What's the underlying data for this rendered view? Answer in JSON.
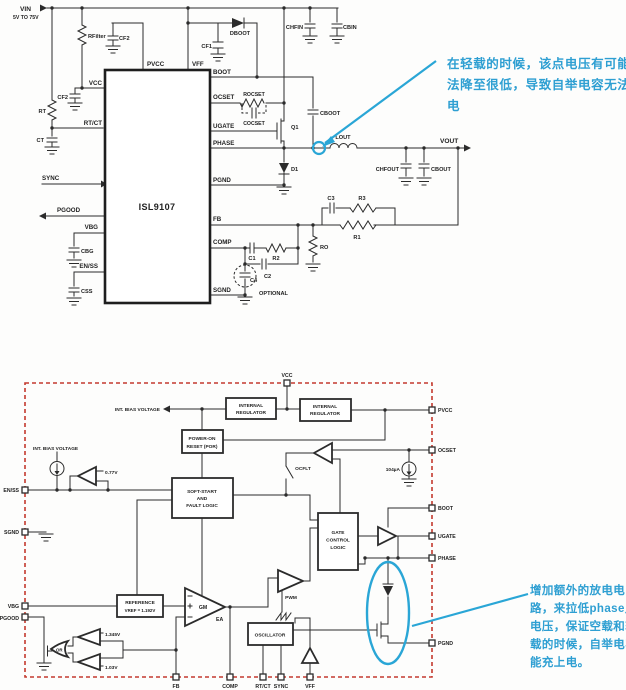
{
  "colors": {
    "accent": "#2aa6d6",
    "dashed_border": "#c43a2e",
    "ink": "#2b2b2b"
  },
  "top": {
    "ic": "ISL9107",
    "vin": "VIN",
    "vin_range": "5V TO 75V",
    "pins": {
      "vcc": "VCC",
      "rtct": "RT/CT",
      "sync": "SYNC",
      "pgood": "PGOOD",
      "vbg": "VBG",
      "enss": "EN/SS",
      "pvcc": "PVCC",
      "vff": "VFF",
      "boot": "BOOT",
      "ocset": "OCSET",
      "ugate": "UGATE",
      "phase": "PHASE",
      "pgnd": "PGND",
      "fb": "FB",
      "comp": "COMP",
      "sgnd": "SGND"
    },
    "parts": {
      "rfilter": "RFilter",
      "cf2": "CF2",
      "cf1": "CF1",
      "dboot": "DBOOT",
      "chfin": "CHFIN",
      "cbin": "CBIN",
      "rt": "RT",
      "ct": "CT",
      "cbg": "CBG",
      "css": "CSS",
      "rocset": "ROCSET",
      "cocset": "COCSET",
      "q1": "Q1",
      "cboot": "CBOOT",
      "d1": "D1",
      "lout": "LOUT",
      "vout": "VOUT",
      "chfout": "CHFOUT",
      "cbout": "CBOUT",
      "c1": "C1",
      "c2": "C2",
      "c3": "C3",
      "c4": "C4",
      "r1": "R1",
      "r2": "R2",
      "r3": "R3",
      "ro": "RO",
      "optional": "OPTIONAL"
    }
  },
  "bd": {
    "pins": {
      "vcc": "VCC",
      "pvcc": "PVCC",
      "ocset": "OCSET",
      "boot": "BOOT",
      "ugate": "UGATE",
      "phase": "PHASE",
      "pgnd": "PGND",
      "enss": "EN/SS",
      "sgnd": "SGND",
      "vbg": "VBG",
      "pgood": "PGOOD",
      "fb": "FB",
      "comp": "COMP",
      "rtct": "RT/CT",
      "sync": "SYNC",
      "vff": "VFF"
    },
    "blocks": {
      "int_reg": [
        "INTERNAL",
        "REGULATOR"
      ],
      "por": [
        "POWER-ON",
        "RESET (POR)"
      ],
      "ss": [
        "SOFT-START",
        "AND",
        "FAULT LOGIC"
      ],
      "ref": [
        "REFERENCE",
        "VREF = 1.192V"
      ],
      "osc": "OSCILLATOR",
      "gcl": [
        "GATE",
        "CONTROL",
        "LOGIC"
      ]
    },
    "labels": {
      "int_bias": "INT. BIAS VOLTAGE",
      "ocflt": "OCFLT",
      "iocset": "104µA",
      "ven": "0.77V",
      "vpg_hi": "1.345V",
      "vpg_lo": "1.03V",
      "gm": "GM",
      "ea": "EA",
      "pwm": "PWM",
      "or_gate": "OR"
    }
  },
  "notes": {
    "n1": [
      "在轻载的时候，该点电压有可能无",
      "法降至很低，导致自举电容无法充",
      "电"
    ],
    "n2": [
      "增加额外的放电电",
      "路，来拉低phase点",
      "电压，保证空载和轻",
      "载的时候，自举电容",
      "能充上电。"
    ]
  }
}
